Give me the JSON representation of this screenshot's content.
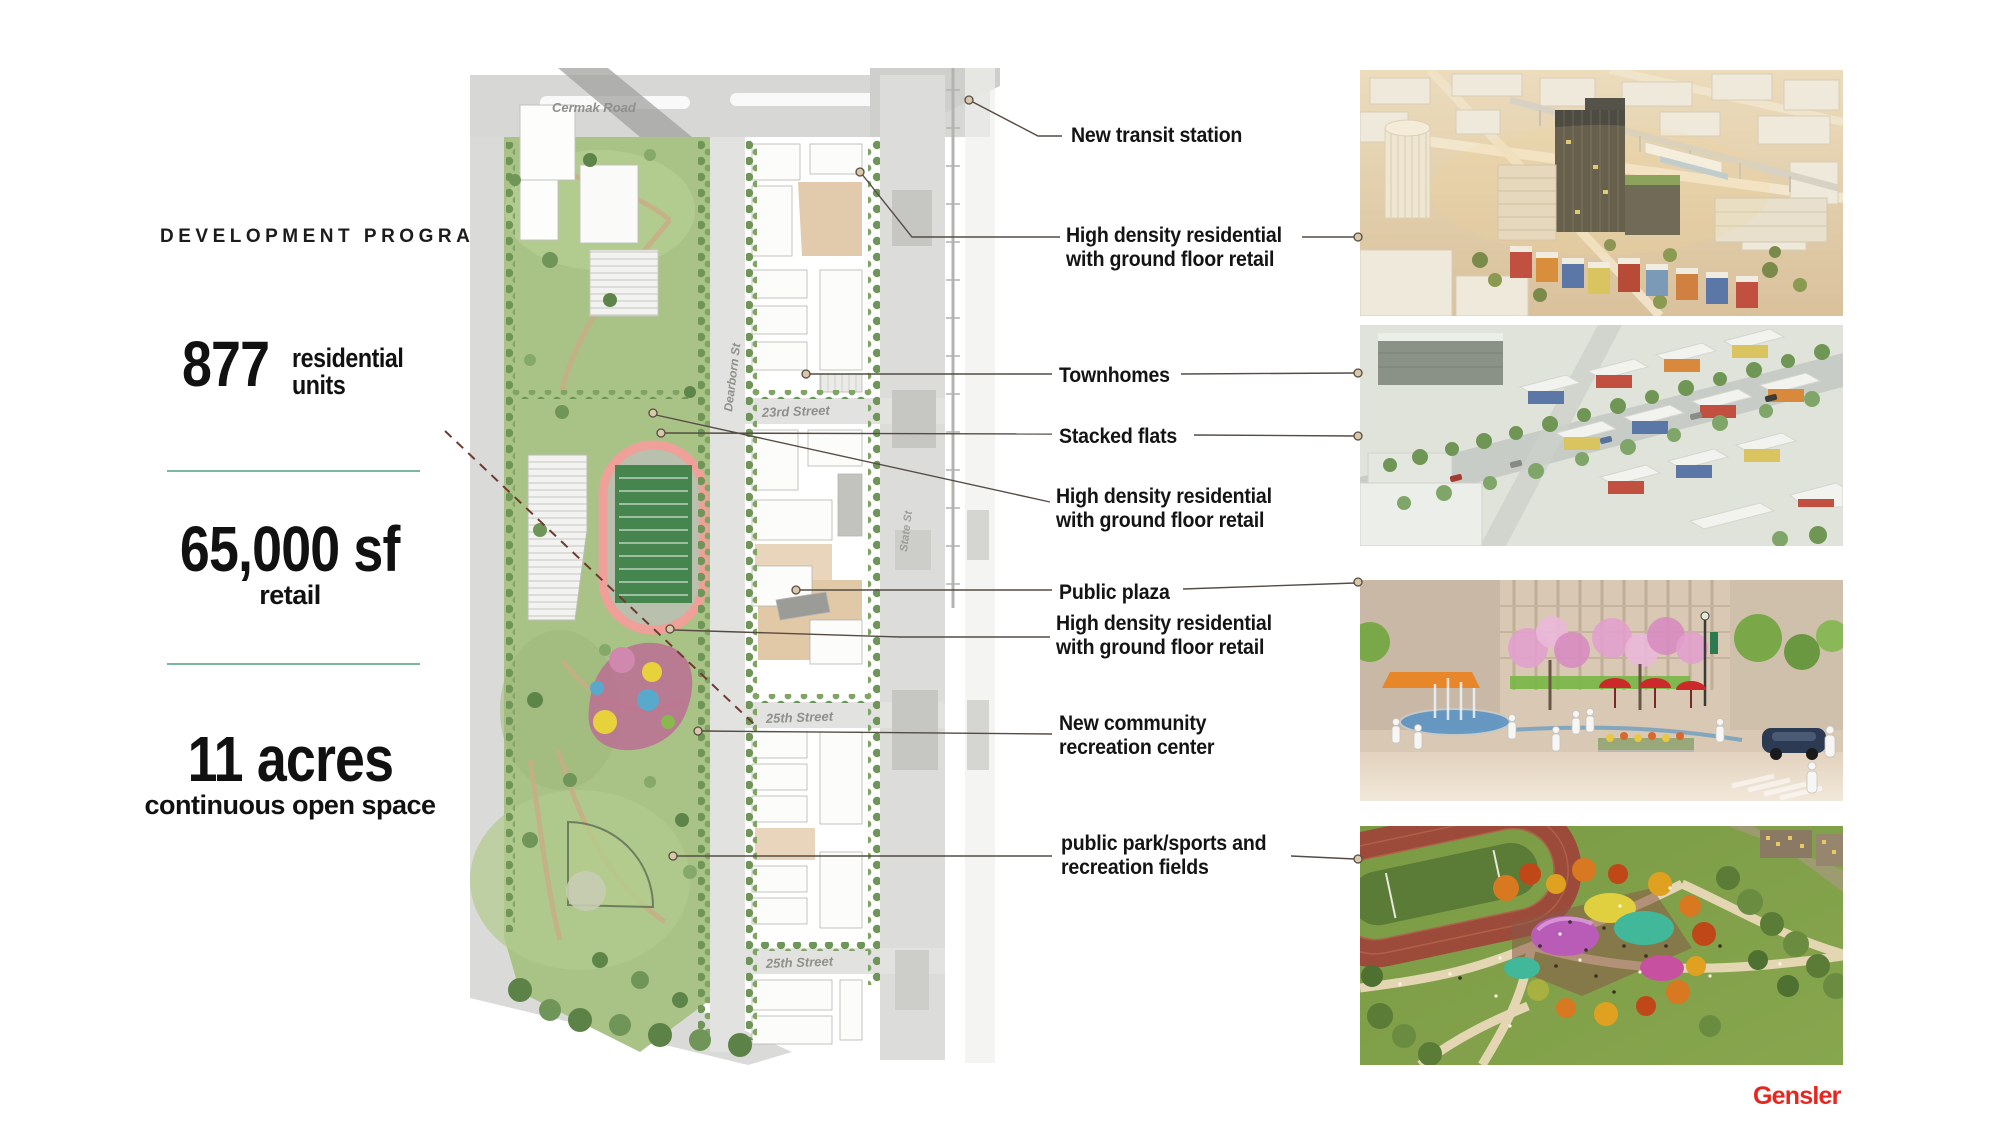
{
  "colors": {
    "accent_green_line": "#7cb79b",
    "logo_red": "#e8251f",
    "leader_line": "#554c44",
    "callout_text": "#141414",
    "track_ring": "#efa099",
    "field_green": "#47854e",
    "playground_pink": "#bc6f93"
  },
  "program": {
    "title": "DEVELOPMENT PROGRAM",
    "stat1_value": "877",
    "stat1_label_line1": "residential",
    "stat1_label_line2": "units",
    "stat2_value": "65,000 sf",
    "stat2_label": "retail",
    "stat3_value": "11 acres",
    "stat3_label": "continuous open space"
  },
  "site_plan": {
    "street_cermak": "Cermak Road",
    "street_dearborn": "Dearborn St",
    "street_23rd": "23rd Street",
    "street_state": "State St",
    "street_25th_upper": "25th Street",
    "street_25th_lower": "25th Street"
  },
  "callouts": {
    "transit": "New transit station",
    "hdr1_line1": "High density residential",
    "hdr1_line2": "with ground floor retail",
    "townhomes": "Townhomes",
    "stacked_flats": "Stacked flats",
    "hdr2_line1": "High density residential",
    "hdr2_line2": "with ground floor retail",
    "public_plaza": "Public plaza",
    "hdr3_line1": "High density residential",
    "hdr3_line2": "with ground floor retail",
    "rec_center_line1": "New community",
    "rec_center_line2": "recreation center",
    "park_line1": "public park/sports and",
    "park_line2": "recreation fields"
  },
  "footer": {
    "logo": "Gensler"
  }
}
